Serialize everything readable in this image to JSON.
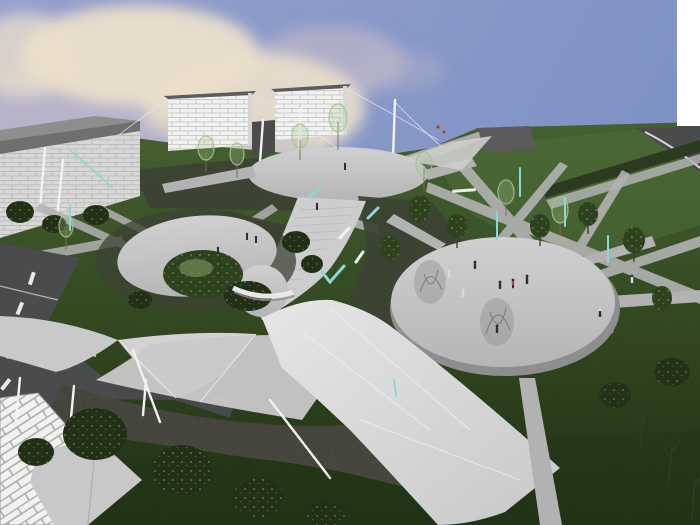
{
  "description": "3D architectural rendering of a landscaped park plaza: blue sky with pink-cream clouds, white brick buildings on a green hill, three light-gray plazas connected by sweeping walkways and stairs, tensile sail canopies, masts, scattered trees and tiny pedestrian figures",
  "palette": {
    "sky-left": "#96A0CB",
    "sky-right": "#7E92C4",
    "cloud-bright": "#EBDFCB",
    "cloud-soft": "#BDB7C9",
    "grass-light": "#4F6D38",
    "grass-mid": "#3B5427",
    "grass-dark": "#243617",
    "planting-dark": "#3C4233",
    "hedge-dark": "#2C3A20",
    "path-light": "#CDCDCD",
    "path-mid": "#B2B2B2",
    "plaza-fill": "#C3C3C3",
    "plaza-rim": "#8E8E8E",
    "road-dark": "#4A4B4C",
    "gravel": "#56554C",
    "ribbon-white": "#DCDCDC",
    "sail-gray": "#C9C9C9",
    "white-struct": "#F1F1F0",
    "brick-line": "#C6C6C6",
    "brick-line-big": "#ADADAD",
    "building-side": "#6F6F6F",
    "roof-dark": "#5B5B5B",
    "teal": "#8BD7D2",
    "trunk": "#5E4630",
    "sketch-gray": "#8F8F8F",
    "tree-dark": "#223018",
    "tree-mid": "#2E4220",
    "leaf-light": "#A5C48F",
    "leaf-speck": "#9DBA6A",
    "mast-white": "#F2F2F2",
    "person-dark": "#2E2E32",
    "person-red": "#B8434E",
    "person-light": "#DADADA",
    "person-yellow": "#C9A227"
  },
  "scene": {
    "plazas": 3,
    "white_buildings": 2,
    "people_on_right_plaza": 9
  }
}
